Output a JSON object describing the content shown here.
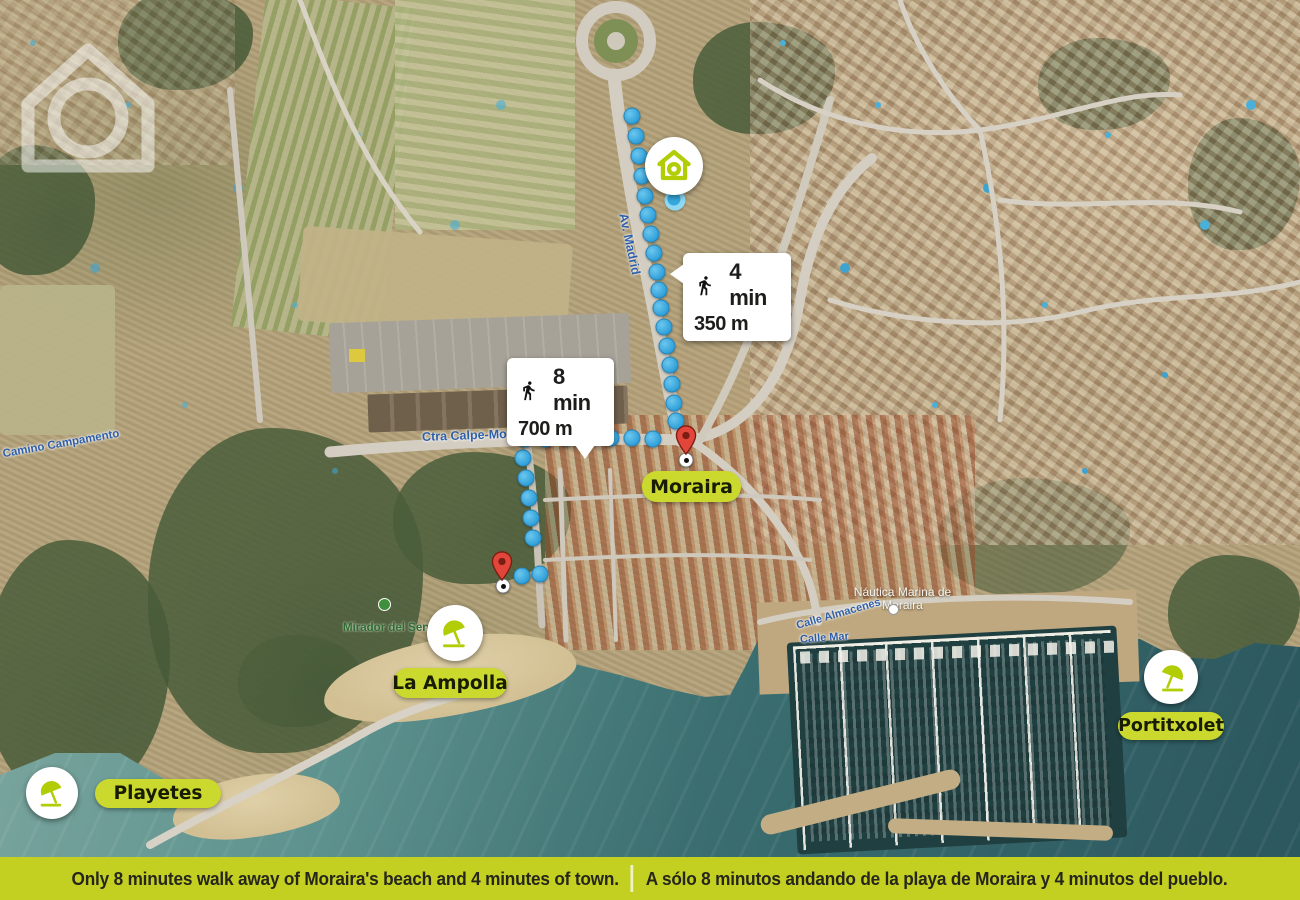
{
  "meta": {
    "description": "Aerial map of Moraira with property location, walking routes and beach labels",
    "colors": {
      "lime_accent": "#bcd00e",
      "pill_background": "#cbd92e",
      "banner_background": "#c3cf21",
      "route_blue": "#3fa9dc",
      "pin_red": "#e2453a",
      "callout_background": "#ffffff",
      "text_dark": "#1d1d1b"
    }
  },
  "property_marker": {
    "icon": "house-icon"
  },
  "callouts": {
    "town": {
      "icon": "walking-person-icon",
      "time": "4 min",
      "dist": "350 m"
    },
    "beach": {
      "icon": "walking-person-icon",
      "time": "8 min",
      "dist": "700 m"
    }
  },
  "places": {
    "moraira": {
      "label": "Moraira"
    },
    "la_ampolla": {
      "label": "La Ampolla",
      "icon": "beach-umbrella-icon"
    },
    "portitxolet": {
      "label": "Portitxolet",
      "icon": "beach-umbrella-icon"
    },
    "playetes": {
      "label": "Playetes",
      "icon": "beach-umbrella-icon"
    }
  },
  "street_labels": {
    "av_madrid": "Av. Madrid",
    "ctra_calpe_moraira": "Ctra Calpe-Moraira",
    "camino_campamento": "Camino Campamento",
    "calle_almacenes": "Calle Almacenes",
    "calle_mar": "Calle Mar",
    "nautica_marina": "Náutica Marina de Moraira",
    "mirador": "Mirador del Senillar"
  },
  "routes": {
    "to_town": [
      [
        632,
        116
      ],
      [
        636,
        136
      ],
      [
        639,
        156
      ],
      [
        642,
        176
      ],
      [
        645,
        196
      ],
      [
        648,
        215
      ],
      [
        651,
        234
      ],
      [
        654,
        253
      ],
      [
        657,
        272
      ],
      [
        659,
        290
      ],
      [
        661,
        308
      ],
      [
        664,
        327
      ],
      [
        667,
        346
      ],
      [
        670,
        365
      ],
      [
        672,
        384
      ],
      [
        674,
        403
      ],
      [
        676,
        421
      ]
    ],
    "to_beach": [
      [
        525,
        439
      ],
      [
        546,
        439
      ],
      [
        567,
        438
      ],
      [
        589,
        438
      ],
      [
        611,
        438
      ],
      [
        632,
        438
      ],
      [
        653,
        439
      ],
      [
        523,
        458
      ],
      [
        526,
        478
      ],
      [
        529,
        498
      ],
      [
        531,
        518
      ],
      [
        533,
        538
      ],
      [
        522,
        576
      ],
      [
        540,
        574
      ]
    ],
    "start_point": [
      675,
      200
    ],
    "town_pin": [
      686,
      455
    ],
    "beach_pin": [
      502,
      580
    ]
  },
  "banner": {
    "text_en": "Only 8 minutes walk away of Moraira's beach and 4 minutes of town.",
    "text_es": "A sólo 8 minutos andando de la playa de Moraira y 4 minutos del pueblo."
  }
}
